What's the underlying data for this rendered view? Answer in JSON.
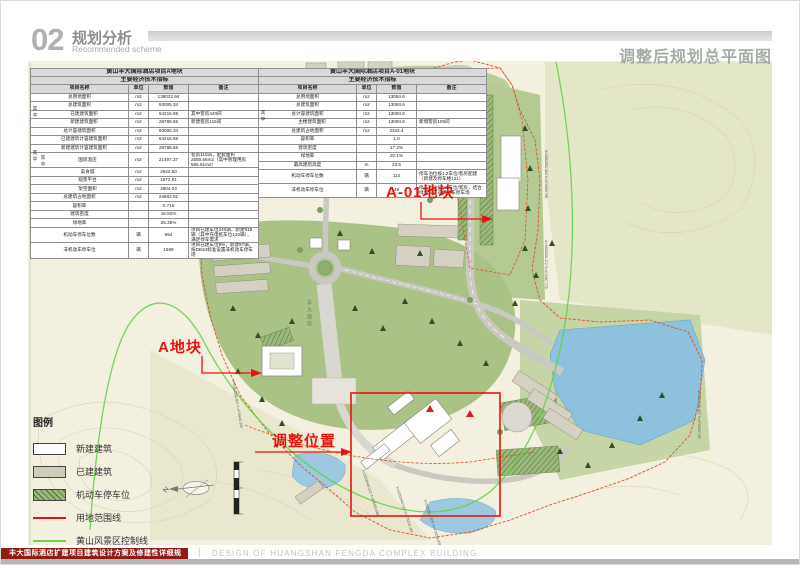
{
  "header": {
    "section_number": "02",
    "section_title": "规划分析",
    "section_subtitle": "Recommended scheme",
    "page_title": "调整后规划总平面图"
  },
  "table_a": {
    "title_line1": "黄山丰大国际酒店项目A地块",
    "title_line2": "主要经济技术指标",
    "columns": [
      "项目名称",
      "单位",
      "数值",
      "备注"
    ],
    "group_label_1": "其中",
    "group_label_2": "其中",
    "group_label_3": "其中",
    "rows": [
      {
        "name": "总用地面积",
        "unit": "m2",
        "value": "138022.94",
        "remark": ""
      },
      {
        "name": "总建筑面积",
        "unit": "m2",
        "value": "93005.34",
        "remark": ""
      },
      {
        "name": "已建建筑面积",
        "unit": "m2",
        "value": "64216.69",
        "remark": "其中客房440间",
        "indent": 1
      },
      {
        "name": "新建建筑面积",
        "unit": "m2",
        "value": "28788.65",
        "remark": "新建客房115间",
        "indent": 1
      },
      {
        "name": "总计容建筑面积",
        "unit": "m2",
        "value": "93005.34",
        "remark": ""
      },
      {
        "name": "已建建筑计容建筑面积",
        "unit": "m2",
        "value": "64216.69",
        "remark": "",
        "indent": 1
      },
      {
        "name": "新建建筑计容建筑面积",
        "unit": "m2",
        "value": "28788.65",
        "remark": "",
        "indent": 1
      },
      {
        "name": "国际酒店",
        "unit": "m2",
        "value": "21497.37",
        "remark": "客房115间，配套面积2550.56m2（其中管理用房586.61m2）",
        "indent": 2,
        "tall": true
      },
      {
        "name": "美食城",
        "unit": "m2",
        "value": "2942.50",
        "remark": "",
        "indent": 2
      },
      {
        "name": "观景平台",
        "unit": "m2",
        "value": "1672.91",
        "remark": "",
        "indent": 2
      },
      {
        "name": "架空面积",
        "unit": "m2",
        "value": "2604.03",
        "remark": "",
        "indent": 2
      },
      {
        "name": "总建筑占地面积",
        "unit": "m2",
        "value": "24602.91",
        "remark": ""
      },
      {
        "name": "容积率",
        "unit": "",
        "value": "0.715",
        "remark": ""
      },
      {
        "name": "建筑密度",
        "unit": "",
        "value": "18.92%",
        "remark": ""
      },
      {
        "name": "绿地率",
        "unit": "",
        "value": "25.35%",
        "remark": ""
      },
      {
        "name": "机动车停车位数",
        "unit": "辆",
        "value": "954",
        "remark": "项目已建车位240辆、新建915辆（其中充电桩车位120辆），满足停车需求",
        "tall": true
      },
      {
        "name": "非机动车停车位",
        "unit": "辆",
        "value": "1589",
        "remark": "项目已建车位9%，新建97辆，按DB34标准设置非机动车停车场",
        "tall": true
      }
    ]
  },
  "table_b": {
    "title_line1": "黄山丰大国际酒店项目A-01地块",
    "title_line2": "主要经济技术指标",
    "columns": [
      "项目名称",
      "单位",
      "数值",
      "备注"
    ],
    "group_label_1": "其中",
    "rows": [
      {
        "name": "总用地面积",
        "unit": "m2",
        "value": "13084.6",
        "remark": ""
      },
      {
        "name": "总建筑面积",
        "unit": "m2",
        "value": "13093.6",
        "remark": ""
      },
      {
        "name": "总计容建筑面积",
        "unit": "m2",
        "value": "13093.6",
        "remark": ""
      },
      {
        "name": "主楼建筑面积",
        "unit": "m2",
        "value": "13093.6",
        "remark": "新增客房105间",
        "indent": 1
      },
      {
        "name": "总建筑占地面积",
        "unit": "m2",
        "value": "2344.4",
        "remark": ""
      },
      {
        "name": "容积率",
        "unit": "",
        "value": "1.0",
        "remark": ""
      },
      {
        "name": "建筑密度",
        "unit": "",
        "value": "17.2%",
        "remark": ""
      },
      {
        "name": "绿地率",
        "unit": "",
        "value": "20.1%",
        "remark": ""
      },
      {
        "name": "最高建筑高度",
        "unit": "m",
        "value": "23.5",
        "remark": ""
      },
      {
        "name": "机动车停车位数",
        "unit": "辆",
        "value": "114",
        "remark": "停车泊位按1.2车位/客房配建（新建及停车楼121）",
        "tall": true
      },
      {
        "name": "非机动车停车位",
        "unit": "辆",
        "value": "49",
        "remark": "停车泊位按0.5车位/客房，结合绿地设置非机动车停车场",
        "tall": true
      }
    ]
  },
  "map": {
    "label_plot_a01": "A-01地块",
    "label_plot_a": "A地块",
    "label_adjust": "调整位置",
    "axis_label": "丰大国际",
    "north": "N",
    "coords": [
      "X=3352552.116 Y=474480.780",
      "X=3352508.172 Y=474487.770",
      "X=3352485.827 Y=474533.705",
      "X=3352546.013 Y=475300.086",
      "X=3352443.023 Y=475202.281",
      "X=3352612.305 Y=475158.028",
      "X=3352390.461 Y=474946.339"
    ]
  },
  "legend": {
    "title": "图例",
    "items": [
      {
        "label": "新建建筑"
      },
      {
        "label": "已建建筑"
      },
      {
        "label": "机动车停车位"
      },
      {
        "label": "用地范围线"
      },
      {
        "label": "黄山风景区控制线"
      }
    ]
  },
  "footer": {
    "title_cn": "丰大国际酒店扩建项目建筑设计方案及修建性详细规划",
    "divider": "|",
    "title_en": "DESIGN OF HUANGSHAN FENGDA COMPLEX BUILDING"
  },
  "colors": {
    "annotation_red": "#e8130c",
    "boundary_red": "#d9542c",
    "scenic_green": "#62d348",
    "footer_red": "#8f1b12",
    "title_gray_green": "#a3ada3",
    "lake_blue": "#8ec1dd"
  }
}
